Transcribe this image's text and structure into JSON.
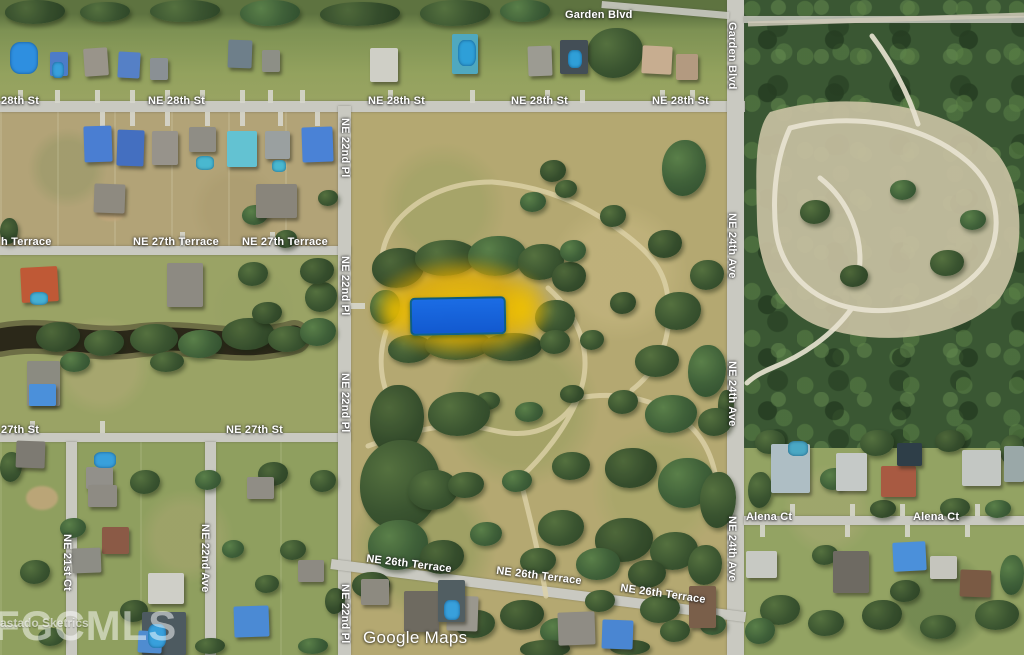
{
  "map": {
    "attribution": "Google Maps",
    "watermark": {
      "small": "astado Sketrics",
      "large": "FGCMLS"
    },
    "highlight": {
      "fill_top": "#1b6ce4",
      "fill_bottom": "#1259cf",
      "glow": "#dcaa00"
    },
    "streets": {
      "labels": [
        {
          "text": "Garden Blvd",
          "x": 565,
          "y": 9,
          "o": "h",
          "rot": 0
        },
        {
          "text": "Garden Blvd",
          "x": 726,
          "y": 22,
          "o": "v",
          "rot": 0
        },
        {
          "text": "28th St",
          "x": 1,
          "y": 95,
          "o": "h",
          "rot": 0
        },
        {
          "text": "NE 28th St",
          "x": 148,
          "y": 95,
          "o": "h",
          "rot": 0
        },
        {
          "text": "NE 28th St",
          "x": 368,
          "y": 95,
          "o": "h",
          "rot": 0
        },
        {
          "text": "NE 28th St",
          "x": 511,
          "y": 95,
          "o": "h",
          "rot": 0
        },
        {
          "text": "NE 28th St",
          "x": 652,
          "y": 95,
          "o": "h",
          "rot": 0
        },
        {
          "text": "NE 22nd Pl",
          "x": 339,
          "y": 118,
          "o": "v",
          "rot": 0
        },
        {
          "text": "NE 22nd Pl",
          "x": 339,
          "y": 256,
          "o": "v",
          "rot": 0
        },
        {
          "text": "NE 22nd Pl",
          "x": 339,
          "y": 373,
          "o": "v",
          "rot": 0
        },
        {
          "text": "NE 22nd Pl",
          "x": 339,
          "y": 584,
          "o": "v",
          "rot": 0
        },
        {
          "text": "h Terrace",
          "x": 1,
          "y": 236,
          "o": "h",
          "rot": 0
        },
        {
          "text": "NE 27th Terrace",
          "x": 133,
          "y": 236,
          "o": "h",
          "rot": 0
        },
        {
          "text": "NE 27th Terrace",
          "x": 242,
          "y": 236,
          "o": "h",
          "rot": 0
        },
        {
          "text": "NE 24th Ave",
          "x": 726,
          "y": 213,
          "o": "v",
          "rot": 0
        },
        {
          "text": "NE 24th Ave",
          "x": 726,
          "y": 361,
          "o": "v",
          "rot": 0
        },
        {
          "text": "NE 24th Ave",
          "x": 726,
          "y": 516,
          "o": "v",
          "rot": 0
        },
        {
          "text": "27th St",
          "x": 1,
          "y": 424,
          "o": "h",
          "rot": 0
        },
        {
          "text": "NE 27th St",
          "x": 226,
          "y": 424,
          "o": "h",
          "rot": 0
        },
        {
          "text": "NE 21st Ct",
          "x": 61,
          "y": 534,
          "o": "v",
          "rot": 0
        },
        {
          "text": "NE 22nd Ave",
          "x": 199,
          "y": 524,
          "o": "v",
          "rot": 0
        },
        {
          "text": "NE 26th Terrace",
          "x": 366,
          "y": 558,
          "o": "h",
          "rot": 7
        },
        {
          "text": "NE 26th Terrace",
          "x": 496,
          "y": 570,
          "o": "h",
          "rot": 7
        },
        {
          "text": "NE 26th Terrace",
          "x": 620,
          "y": 588,
          "o": "h",
          "rot": 8
        },
        {
          "text": "Alena Ct",
          "x": 746,
          "y": 511,
          "o": "h",
          "rot": 0
        },
        {
          "text": "Alena Ct",
          "x": 913,
          "y": 511,
          "o": "h",
          "rot": 0
        }
      ]
    }
  }
}
